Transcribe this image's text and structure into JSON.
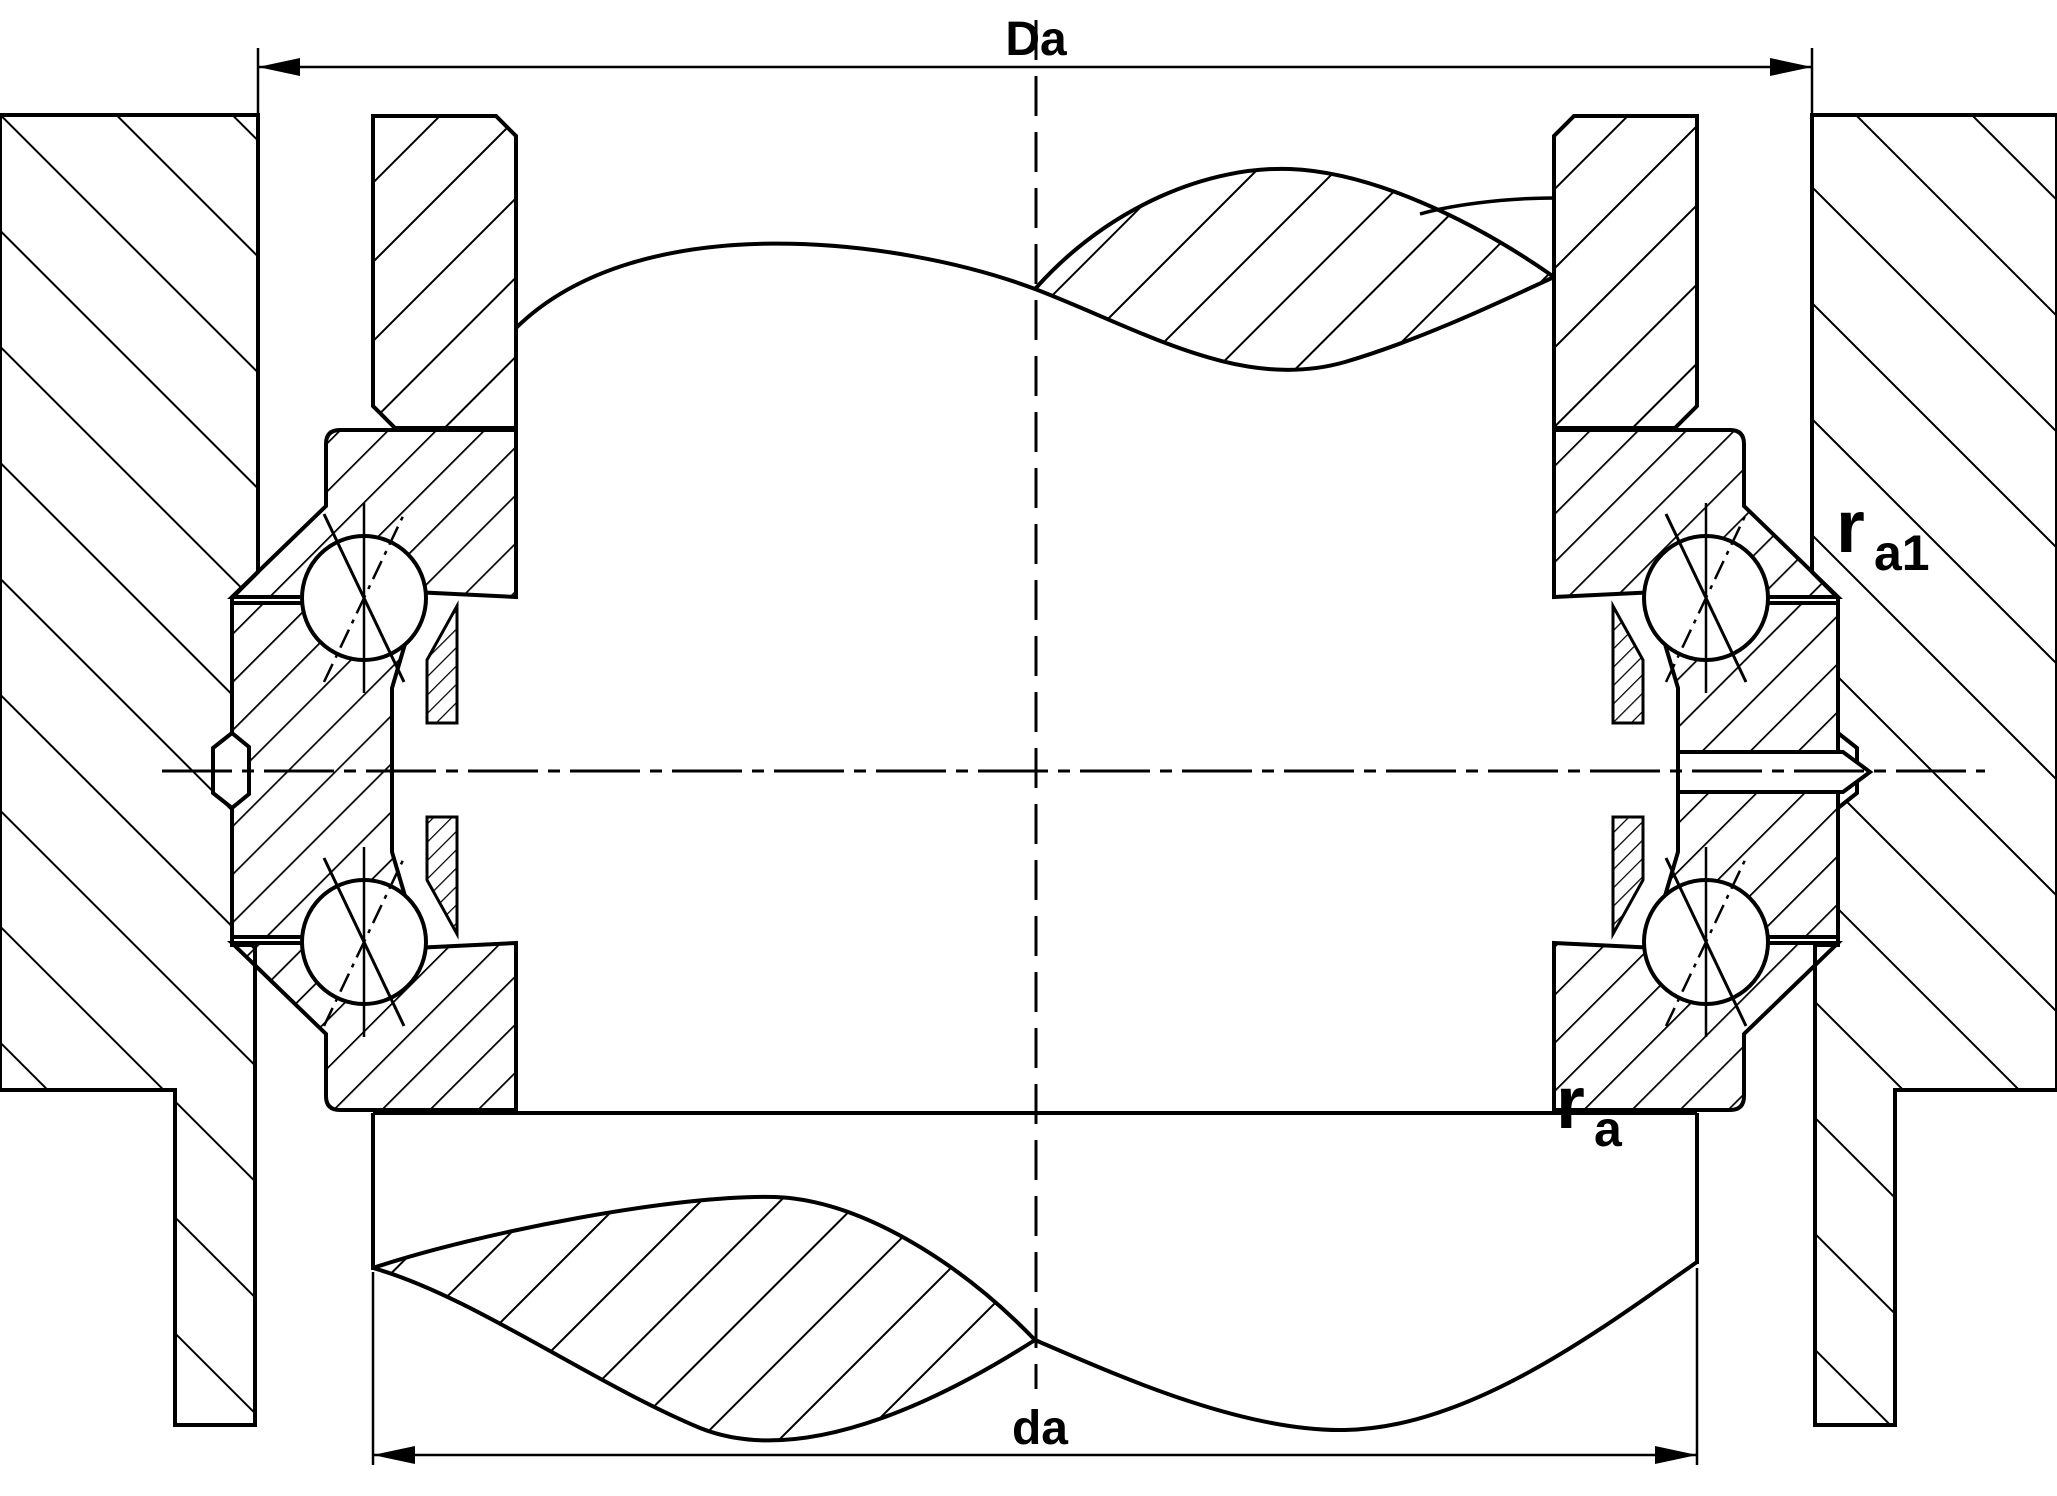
{
  "drawing": {
    "type": "bearing-mounting-cross-section",
    "dimensions": {
      "outer_diameter": {
        "label": "Da"
      },
      "inner_diameter": {
        "label": "da"
      }
    },
    "labels": {
      "fillet_housing": {
        "base": "r",
        "sub": "a1"
      },
      "fillet_shaft": {
        "base": "r",
        "sub": "a"
      }
    },
    "colors": {
      "line": "#000000",
      "background": "#ffffff"
    }
  }
}
